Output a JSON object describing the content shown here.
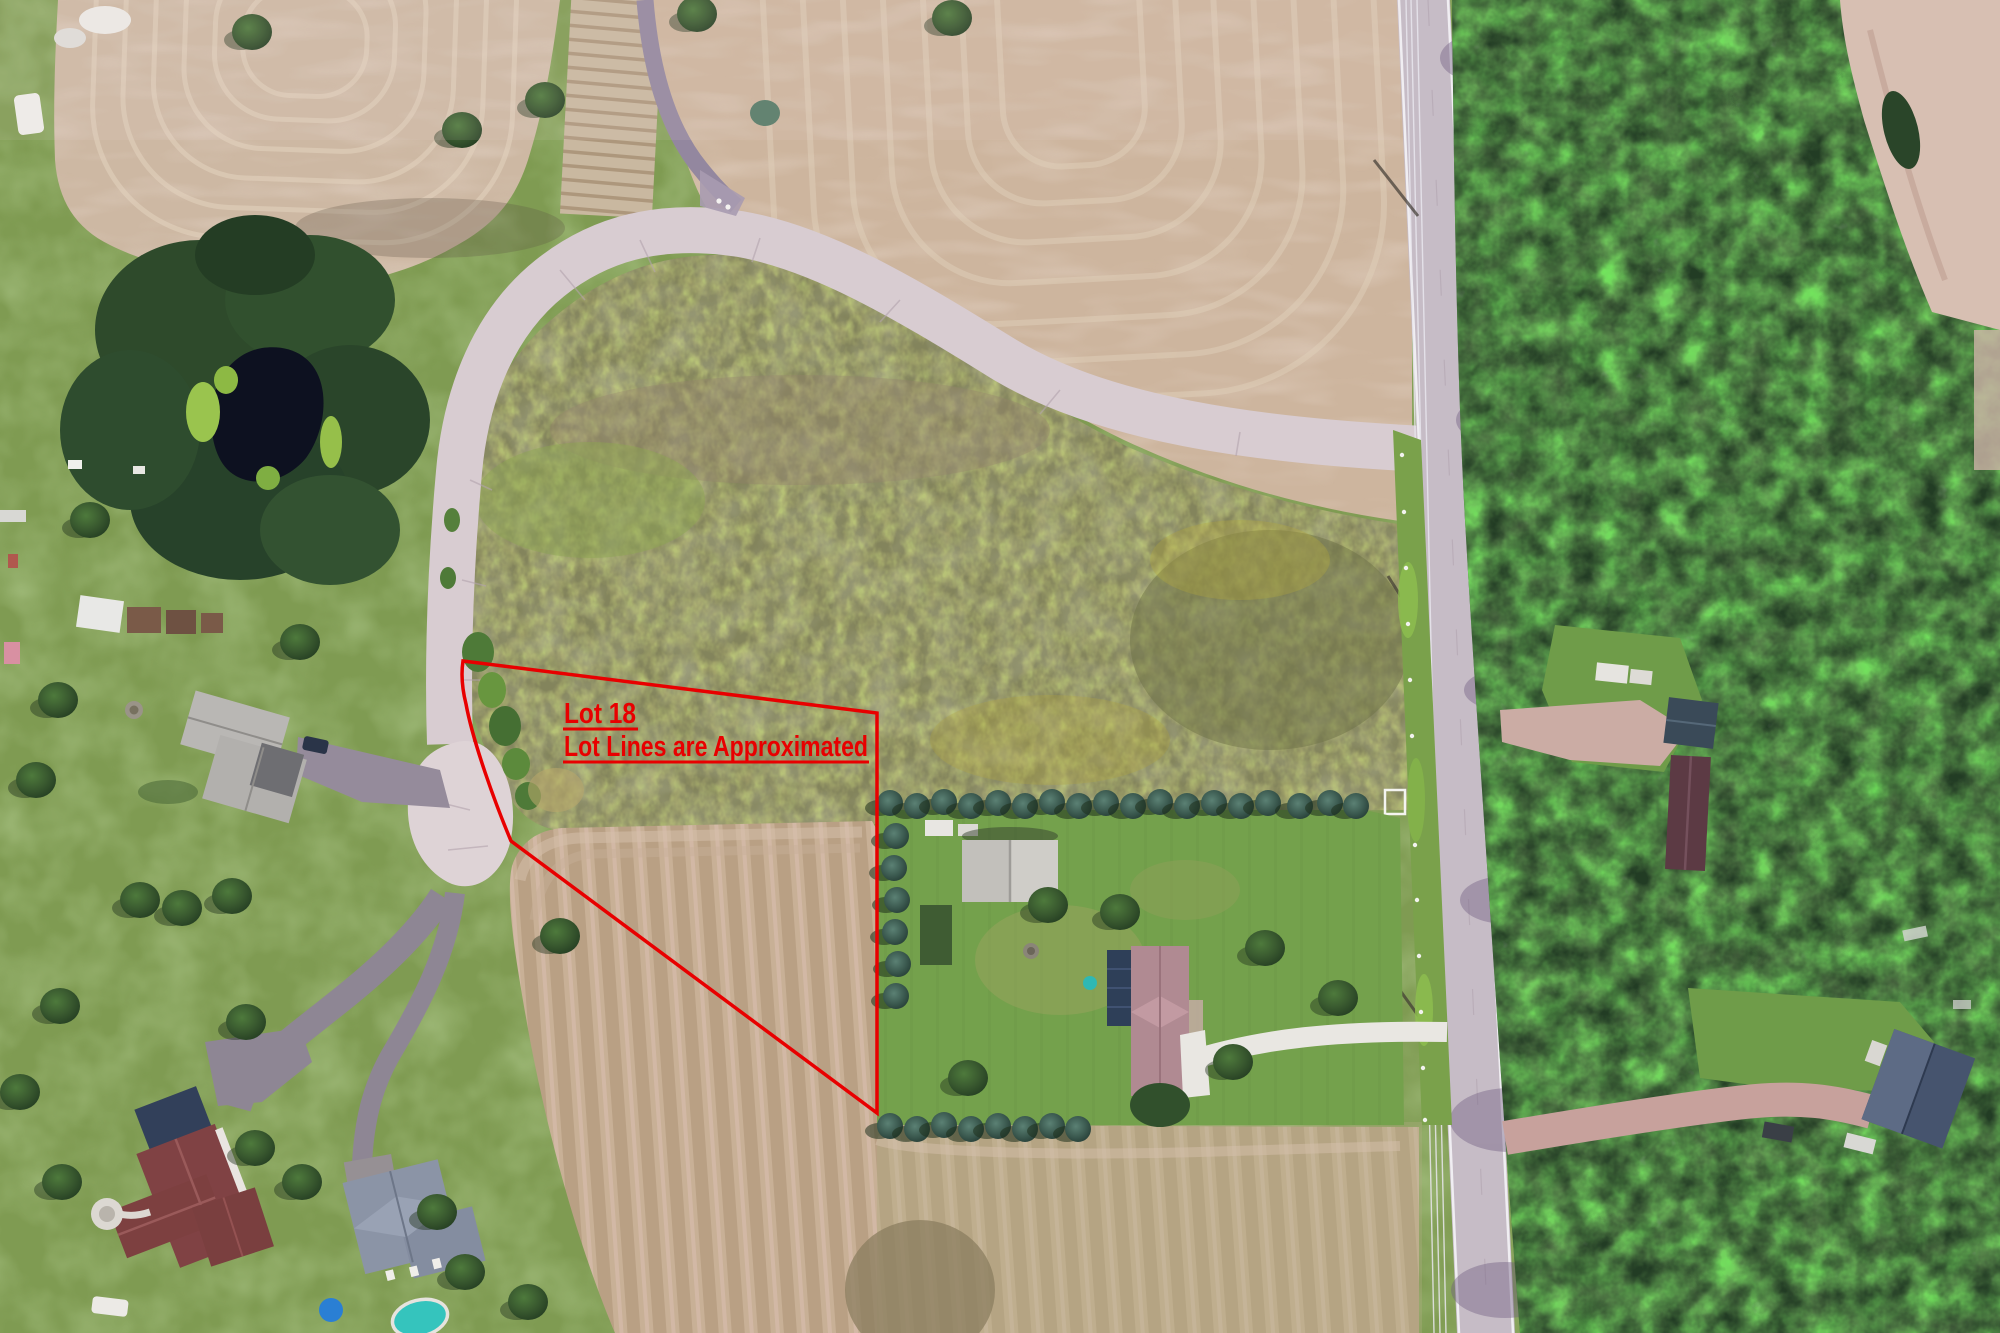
{
  "annotation": {
    "lot_label": "Lot 18",
    "disclaimer": "Lot Lines are Approximated",
    "color": "#e80000"
  },
  "palette": {
    "grass": "#7f9b52",
    "lawn_bright": "#74a14c",
    "meadow_olive": "#83845c",
    "field_tan": "#cdb59e",
    "field_stripe_dark": "#bda689",
    "road_concrete": "#d8ccd1",
    "road_asphalt_main": "#c6bcc6",
    "driveway_asphalt": "#8e8694",
    "driveway_dirt": "#cbaca4",
    "forest_dark": "#223c24",
    "pond_water": "#0d1120",
    "pool_water": "#35c4bd",
    "roof_red": "#7d4040",
    "roof_mauve": "#b08a92",
    "roof_slate": "#8b94a6",
    "roof_navy": "#3a4a58",
    "barn_gray": "#cfcdc8"
  },
  "features": {
    "photo_type": "aerial-drone-photo",
    "lot_boundary": "lot-18-approximate-boundary",
    "labels": [
      "Lot 18",
      "Lot Lines are Approximated"
    ]
  }
}
